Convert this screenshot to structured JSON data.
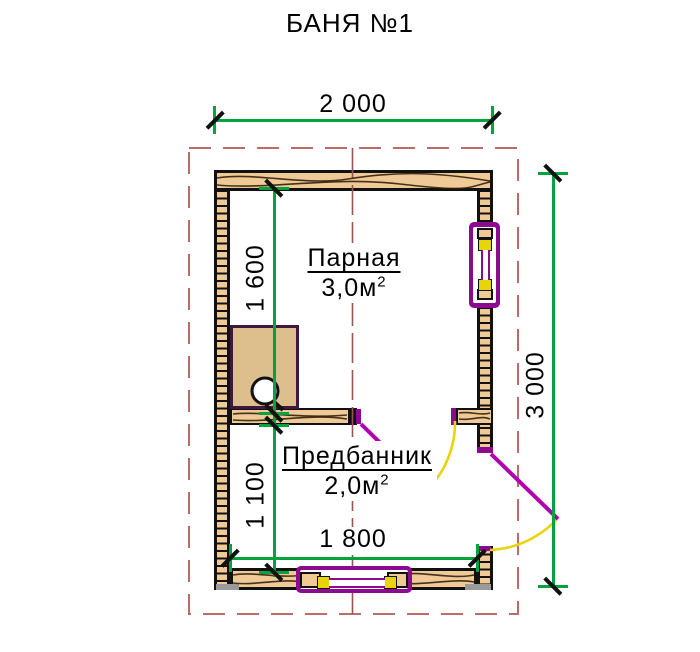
{
  "title": "БАНЯ №1",
  "dimensions": {
    "total_width": "2 000",
    "total_height": "3 000",
    "parnaya_depth": "1 600",
    "predbannik_depth": "1 100",
    "inner_width": "1 800"
  },
  "rooms": {
    "parnaya": {
      "name": "Парная",
      "area": "3,0м",
      "area_sup": "2"
    },
    "predbannik": {
      "name": "Предбанник",
      "area": "2,0м",
      "area_sup": "2"
    }
  },
  "colors": {
    "green": "#00a43e",
    "boundary": "#bc6b6b",
    "axis": "#9b5252",
    "wood": "#efca96",
    "stove-wood": "#dcbf8c",
    "outline": "#111111",
    "purple": "#8b0a8f",
    "door": "#af00af",
    "yellow": "#e8d409",
    "grain": "#33200e",
    "grey": "#9a9a9a"
  }
}
